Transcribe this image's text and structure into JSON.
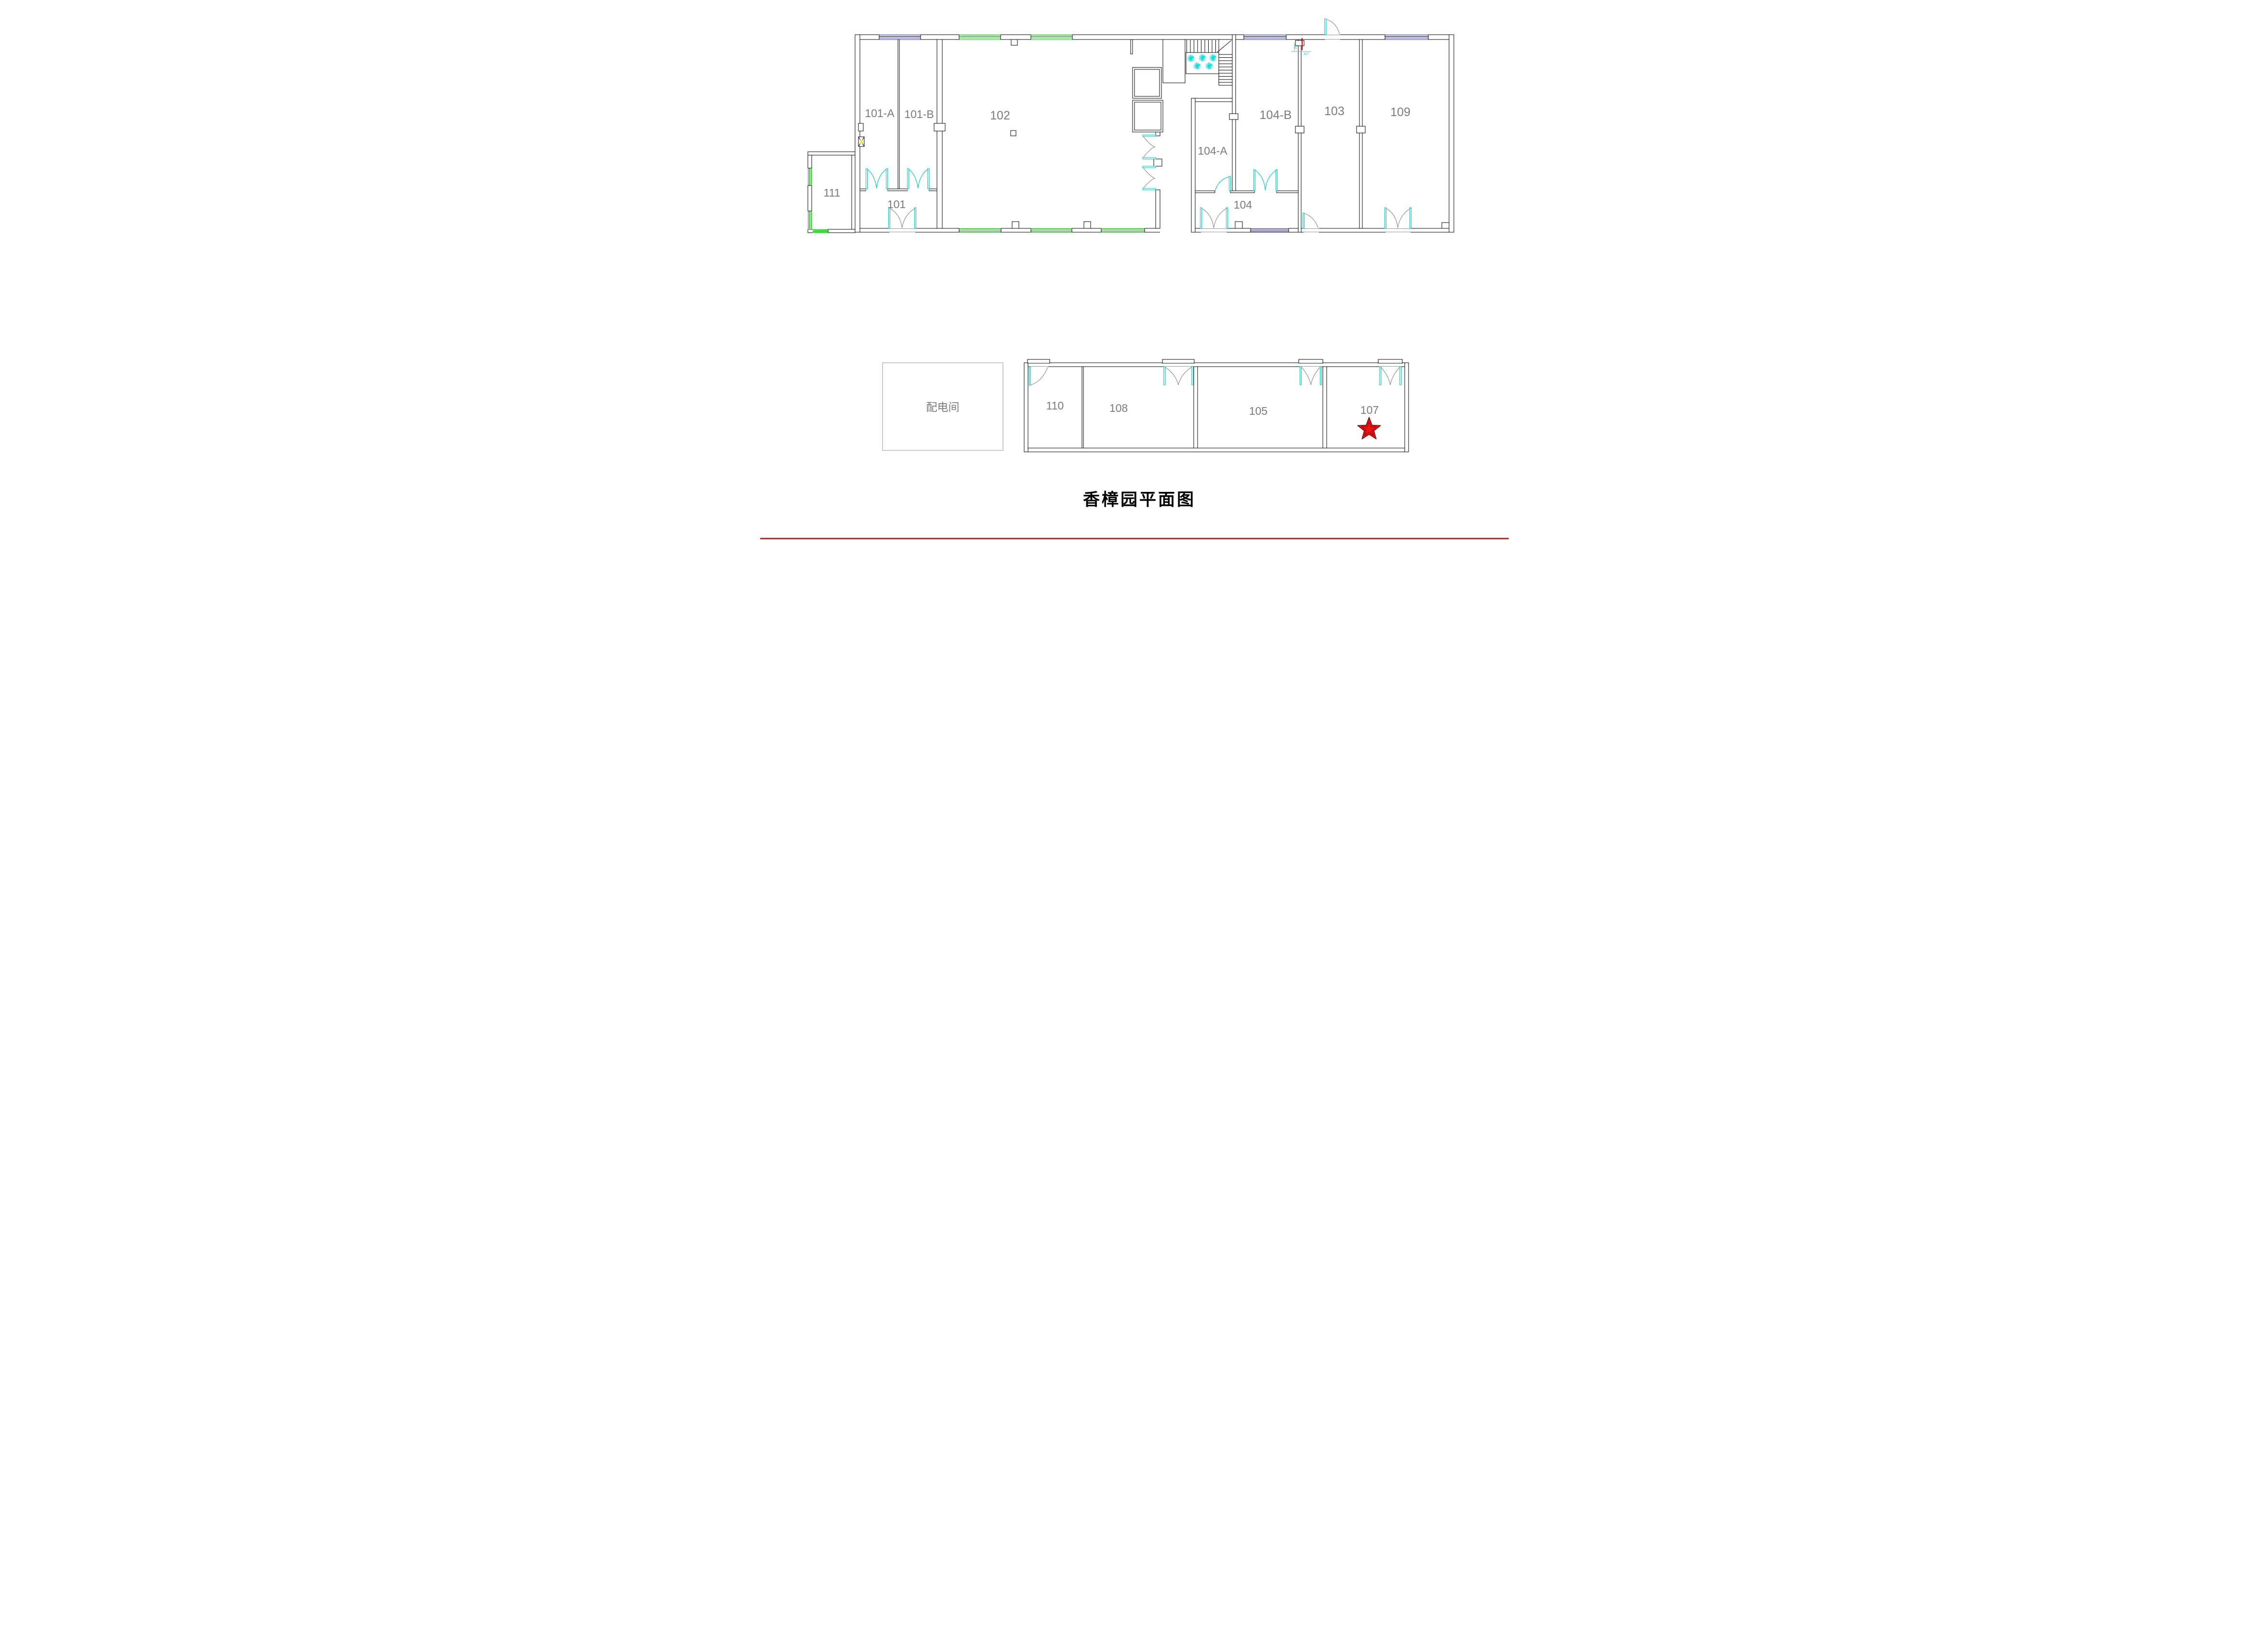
{
  "title": "香樟园平面图",
  "rooms": {
    "r101a": "101-A",
    "r101b": "101-B",
    "r101": "101",
    "r102": "102",
    "r103": "103",
    "r104": "104",
    "r104a": "104-A",
    "r104b": "104-B",
    "r109": "109",
    "r110": "110",
    "r111": "111",
    "r105": "105",
    "r107": "107",
    "r108": "108",
    "power_room": "配电间"
  },
  "annotations": {
    "dim_vertical": "266",
    "dim_horizontal": "427"
  },
  "colors": {
    "wall": "#000000",
    "room_label": "#7b7b7b",
    "door_cyan": "#00d2d2",
    "door_arc_gray": "#8a8a8a",
    "window_green": "#00c800",
    "window_blue": "#2828b4",
    "plant_cyan": "#00e0e0",
    "column_yellow": "#e8e800",
    "star_fill": "#ee1111",
    "star_outline": "#7a0000",
    "red_accent": "#dd0000",
    "bottom_rule_red": "#c11212",
    "power_room_border": "#a6a6a6"
  }
}
